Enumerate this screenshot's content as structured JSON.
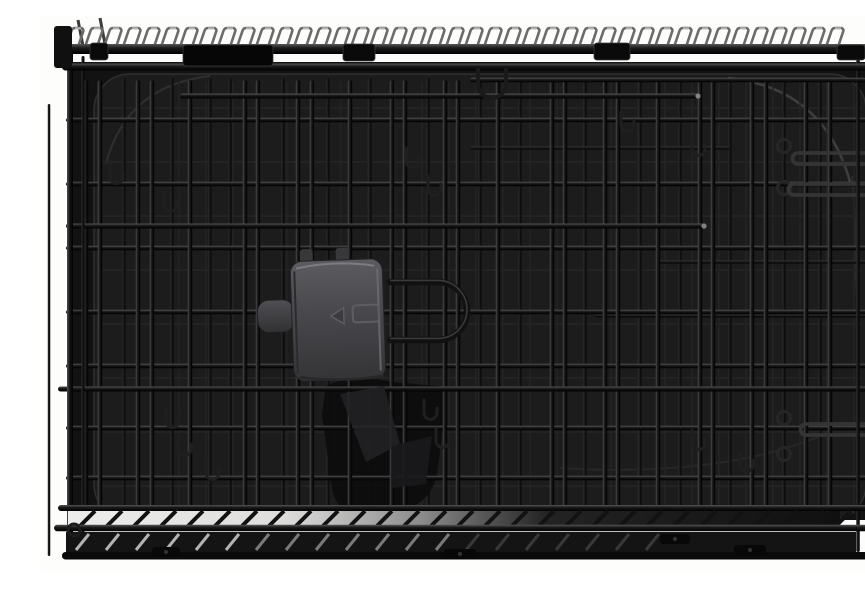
{
  "subject": "black folding double-door wire dog crate with black plastic pan, product photo on a white background",
  "palette": {
    "background": "#fdfdfc",
    "interior": "#121212",
    "tray": "#1c1c1c",
    "tray_rim": "#2f2f2f",
    "tray_highlight": "#434343",
    "wire_front": "#0d0d0d",
    "wire_mid": "#2b2b2b",
    "wire_back": "#232323",
    "wire_highlight": "#4a4a4a",
    "glossy_wire": "#343434",
    "loop": "#6b6b6b",
    "loop_highlight": "#bdbdbd",
    "clip": "#0a0a0a",
    "clip_edge": "#3a3a3a",
    "latch_face_top": "#5c5c60",
    "latch_face_bottom": "#343437",
    "latch_highlight": "#83838a",
    "latch_emboss": "#5d5d63",
    "secondary_latch": "#0c0c0c",
    "base_band_light": "#ededec",
    "base_slat_light": "#cfcfcd"
  },
  "scene": {
    "canvas": {
      "w": 865,
      "h": 557
    },
    "interior": {
      "x": 32,
      "y": 46,
      "w": 806,
      "h": 458
    },
    "tray": {
      "x": 54,
      "y": 58,
      "w": 772,
      "h": 446,
      "rx": 36
    },
    "top": {
      "loops": {
        "count": 41,
        "start": 26,
        "step": 19
      },
      "rails": [
        {
          "x1": 16,
          "x2": 833,
          "y": 33,
          "w": 10
        },
        {
          "x1": 22,
          "x2": 828,
          "y": 51,
          "w": 7
        },
        {
          "x1": 430,
          "x2": 826,
          "y": 64,
          "w": 4.5
        }
      ],
      "clips": [
        {
          "x": 143,
          "y": 29,
          "w": 90,
          "h": 21,
          "big": true
        },
        {
          "x": 50,
          "y": 27,
          "w": 18,
          "h": 17
        },
        {
          "x": 303,
          "y": 28,
          "w": 32,
          "h": 17
        },
        {
          "x": 554,
          "y": 27,
          "w": 36,
          "h": 17
        },
        {
          "x": 797,
          "y": 29,
          "w": 28,
          "h": 15
        }
      ],
      "hanging_hook": {
        "x": 438,
        "y": 52,
        "w": 28,
        "depth": 30
      },
      "spikes": [
        [
          38,
          4
        ],
        [
          60,
          2
        ]
      ]
    },
    "grids": {
      "back": {
        "x1": 58,
        "x2": 822,
        "y1": 66,
        "y2": 498,
        "vstep": 27,
        "hstep": 54
      },
      "mid_verticals": [
        84,
        132,
        170,
        190,
        243,
        288,
        330,
        388,
        440,
        480,
        545,
        600,
        640,
        690,
        744,
        780
      ],
      "front_verticals": [
        46,
        60,
        98,
        112,
        150,
        205,
        218,
        258,
        272,
        310,
        352,
        365,
        405,
        418,
        458,
        512,
        525,
        565,
        578,
        618,
        660,
        673,
        712,
        726,
        766,
        790
      ],
      "front_horizontals": [
        104,
        168,
        232,
        296,
        350,
        412,
        462
      ],
      "bright_partials": [
        {
          "y": 80,
          "x1": 140,
          "x2": 658
        },
        {
          "y": 210,
          "x1": 26,
          "x2": 664
        },
        {
          "y": 373,
          "x1": 18,
          "x2": 852
        }
      ],
      "mid_partials": [
        {
          "y": 132,
          "x1": 430,
          "x2": 690
        },
        {
          "y": 246,
          "x1": 618,
          "x2": 838
        },
        {
          "y": 300,
          "x1": 556,
          "x2": 838
        }
      ]
    },
    "frame": {
      "left_posts": [
        {
          "x": 9,
          "w": 2.5,
          "y1": 88,
          "y2": 540,
          "mid": true
        },
        {
          "x": 30,
          "w": 6,
          "y1": 28,
          "y2": 543
        },
        {
          "x": 43,
          "w": 3,
          "y1": 40,
          "y2": 540,
          "mid": true
        }
      ],
      "right_posts": [
        {
          "x": 818,
          "w": 3.5,
          "y1": 42,
          "y2": 536,
          "mid": true
        },
        {
          "x": 835,
          "w": 6,
          "y1": 26,
          "y2": 538
        }
      ]
    },
    "hooks": {
      "j_hooks": [
        [
          70,
          148
        ],
        [
          124,
          176
        ],
        [
          366,
          132
        ],
        [
          388,
          160
        ],
        [
          581,
          96
        ],
        [
          652,
          120
        ],
        [
          126,
          392
        ],
        [
          138,
          420
        ],
        [
          384,
          384
        ],
        [
          396,
          412
        ],
        [
          166,
          444
        ],
        [
          652,
          414
        ],
        [
          700,
          436
        ]
      ],
      "ring_hooks": [
        [
          744,
          130
        ],
        [
          744,
          172
        ],
        [
          744,
          402
        ],
        [
          744,
          438
        ]
      ],
      "hairpins": [
        {
          "x1": 758,
          "x2": 857,
          "y": 137
        },
        {
          "x1": 754,
          "x2": 857,
          "y": 168
        },
        {
          "x1": 766,
          "x2": 857,
          "y": 408
        }
      ]
    },
    "handle": {
      "x": 350,
      "y": 266,
      "arm": 48,
      "radius": 29
    },
    "latch": {
      "plate": {
        "x": 252,
        "y": 244,
        "w": 92,
        "h": 120,
        "rx": 12,
        "tilt": -2
      },
      "tab": {
        "x": 218,
        "y": 282,
        "w": 36,
        "h": 32,
        "rx": 11
      },
      "nubs": [
        [
          262,
          232
        ],
        [
          298,
          232
        ]
      ],
      "emboss": {
        "rect": [
          313,
          290,
          26,
          17
        ],
        "arrow": [
          304,
          292,
          304,
          308,
          291,
          300
        ]
      }
    },
    "base": {
      "rail_b_y": 492,
      "rail_c_y": 512,
      "band1": {
        "x": 28,
        "y": 495,
        "w": 772,
        "h": 16
      },
      "band2": {
        "x": 26,
        "y": 516,
        "w": 790,
        "h": 20
      },
      "bottom_rail": {
        "x": 22,
        "y": 536,
        "w": 820,
        "h": 7.5
      },
      "slat_step": 27,
      "feet": [
        [
          112,
          531,
          28,
          10
        ],
        [
          404,
          533,
          32,
          10
        ],
        [
          620,
          518,
          30,
          10
        ],
        [
          694,
          529,
          32,
          10
        ]
      ]
    }
  }
}
